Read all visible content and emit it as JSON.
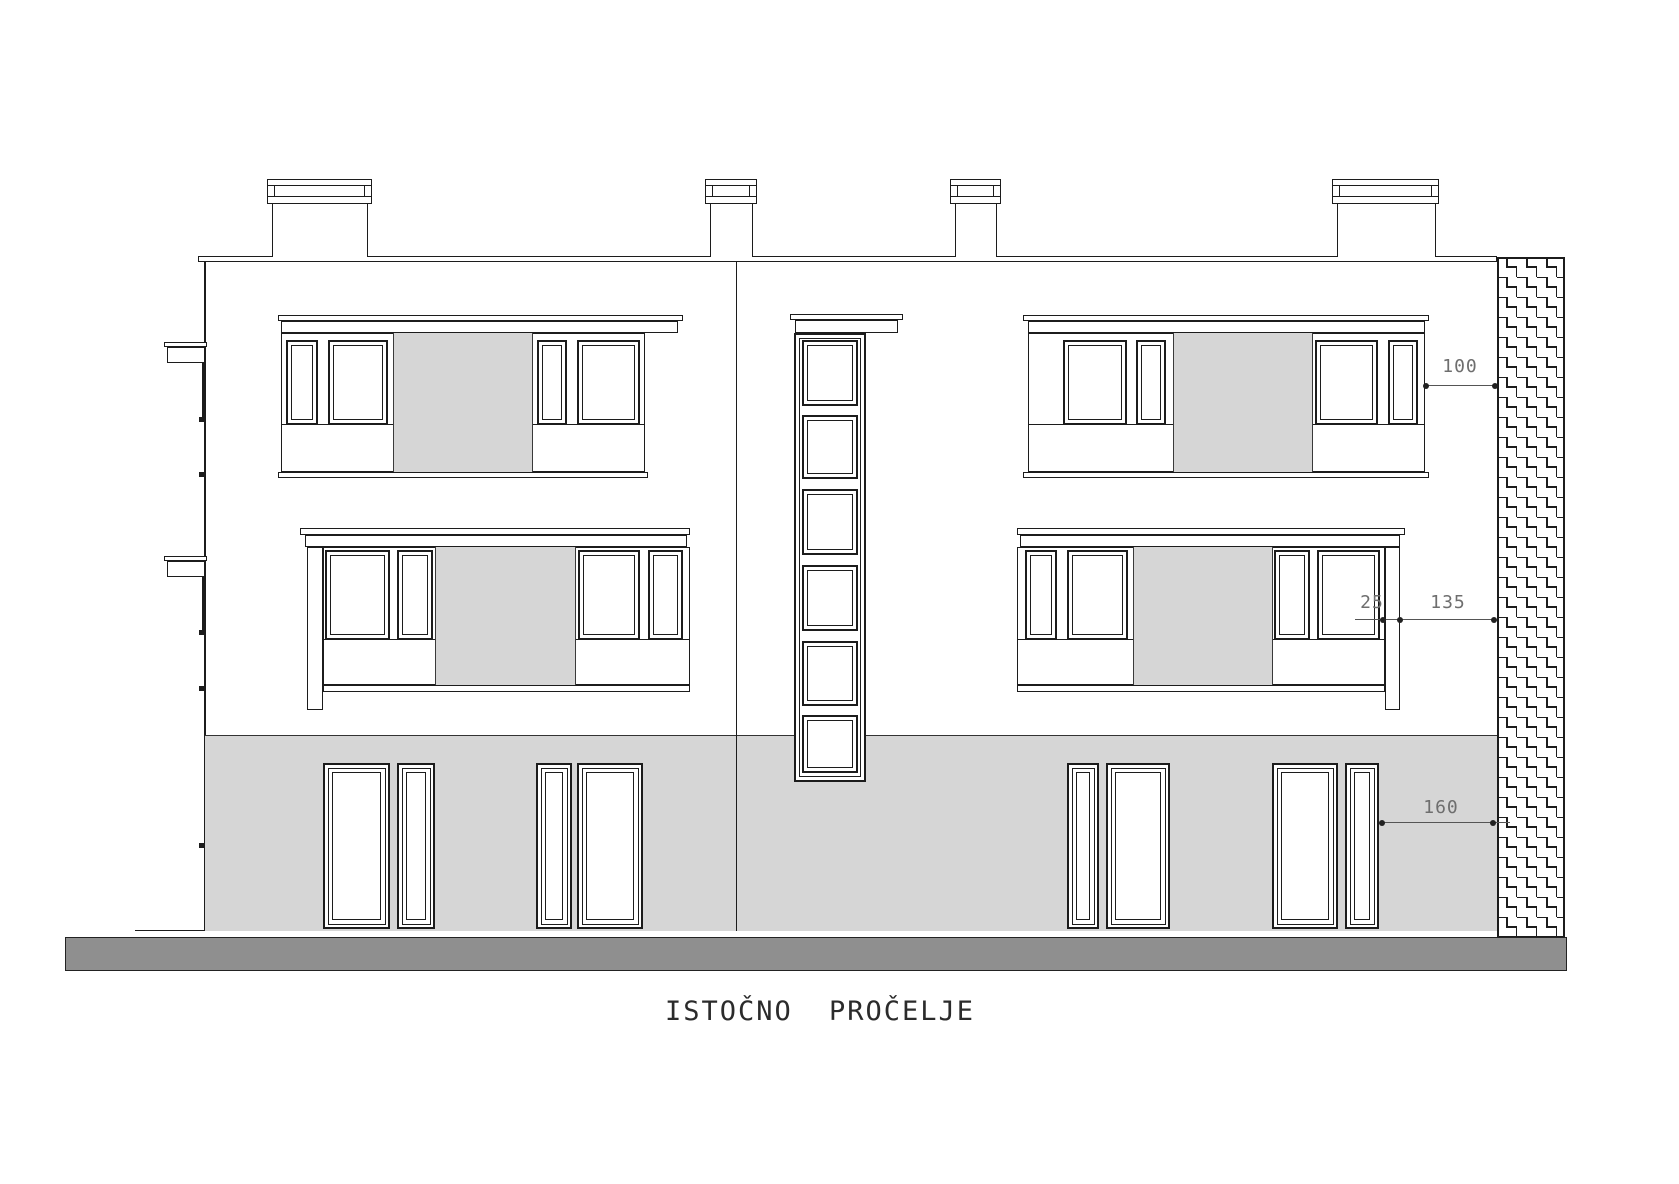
{
  "title": "ISTOČNO PROČELJE",
  "dimensions": [
    {
      "id": "dim-100",
      "value": "100"
    },
    {
      "id": "dim-25",
      "value": "25"
    },
    {
      "id": "dim-135",
      "value": "135"
    },
    {
      "id": "dim-160",
      "value": "160"
    }
  ],
  "colors": {
    "line": "#1c1c1c",
    "panel": "#d6d6d6",
    "ground_bar": "#8f8f8f",
    "dim_text": "#6e6e6e",
    "background": "#ffffff"
  }
}
